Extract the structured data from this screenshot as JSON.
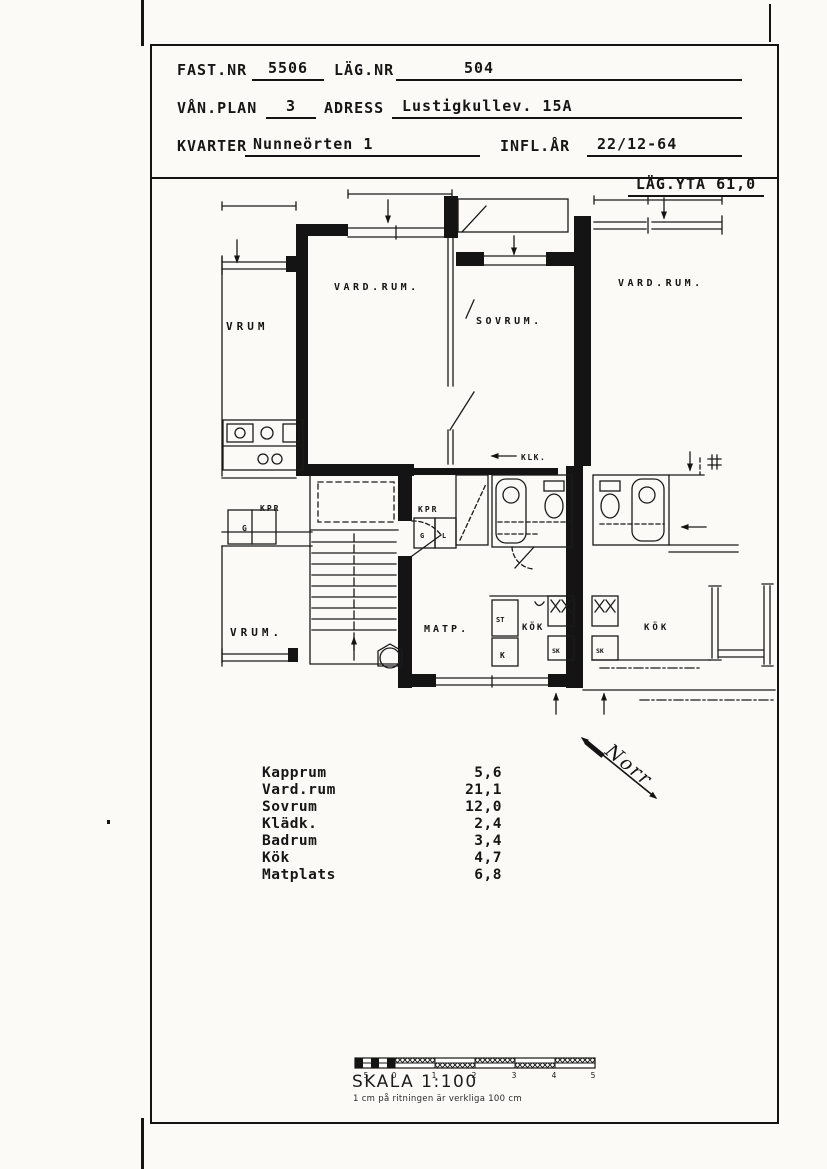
{
  "header": {
    "fast_nr_label": "FAST.NR",
    "fast_nr_value": "5506",
    "lag_nr_label": "LÄG.NR",
    "lag_nr_value": "504",
    "van_plan_label": "VÅN.PLAN",
    "van_plan_value": "3",
    "adress_label": "ADRESS",
    "adress_value": "Lustigkullev. 15A",
    "kvarter_label": "KVARTER",
    "kvarter_value": "Nunneörten 1",
    "infl_ar_label": "INFL.ÅR",
    "infl_ar_value": "22/12-64"
  },
  "area_banner": {
    "label": "LÄG.YTA",
    "value": "61,0"
  },
  "plan": {
    "labels": {
      "neighbor_left_room": "VRUM",
      "vardrum": "VARD.RUM.",
      "sovrum": "SOVRUM.",
      "neighbor_right_room": "VARD.RUM.",
      "klk": "KLK.",
      "neighbor_left_kpr": "KPR",
      "kpr": "KPR",
      "neighbor_left_g": "G",
      "garderob_g": "G",
      "garderob_l": "L",
      "neighbor_left_room_lower": "VRUM.",
      "matp": "MATP.",
      "st": "ST",
      "kyl": "K",
      "kok": "KÖK",
      "sk": "SK",
      "neighbor_right_sk": "SK",
      "neighbor_right_kok": "KÖK"
    },
    "north_label": "Norr"
  },
  "area_table": {
    "rows": [
      {
        "name": "Kapprum",
        "area": "5,6"
      },
      {
        "name": "Vard.rum",
        "area": "21,1"
      },
      {
        "name": "Sovrum",
        "area": "12,0"
      },
      {
        "name": "Klädk.",
        "area": "2,4"
      },
      {
        "name": "Badrum",
        "area": "3,4"
      },
      {
        "name": "Kök",
        "area": "4,7"
      },
      {
        "name": "Matplats",
        "area": "6,8"
      }
    ]
  },
  "scale_bar": {
    "title": "SKALA 1:100",
    "subtitle": "1 cm på ritningen är verkliga 100 cm",
    "tick_labels": [
      "5",
      "0",
      "1",
      "2",
      "3",
      "4",
      "5"
    ]
  }
}
